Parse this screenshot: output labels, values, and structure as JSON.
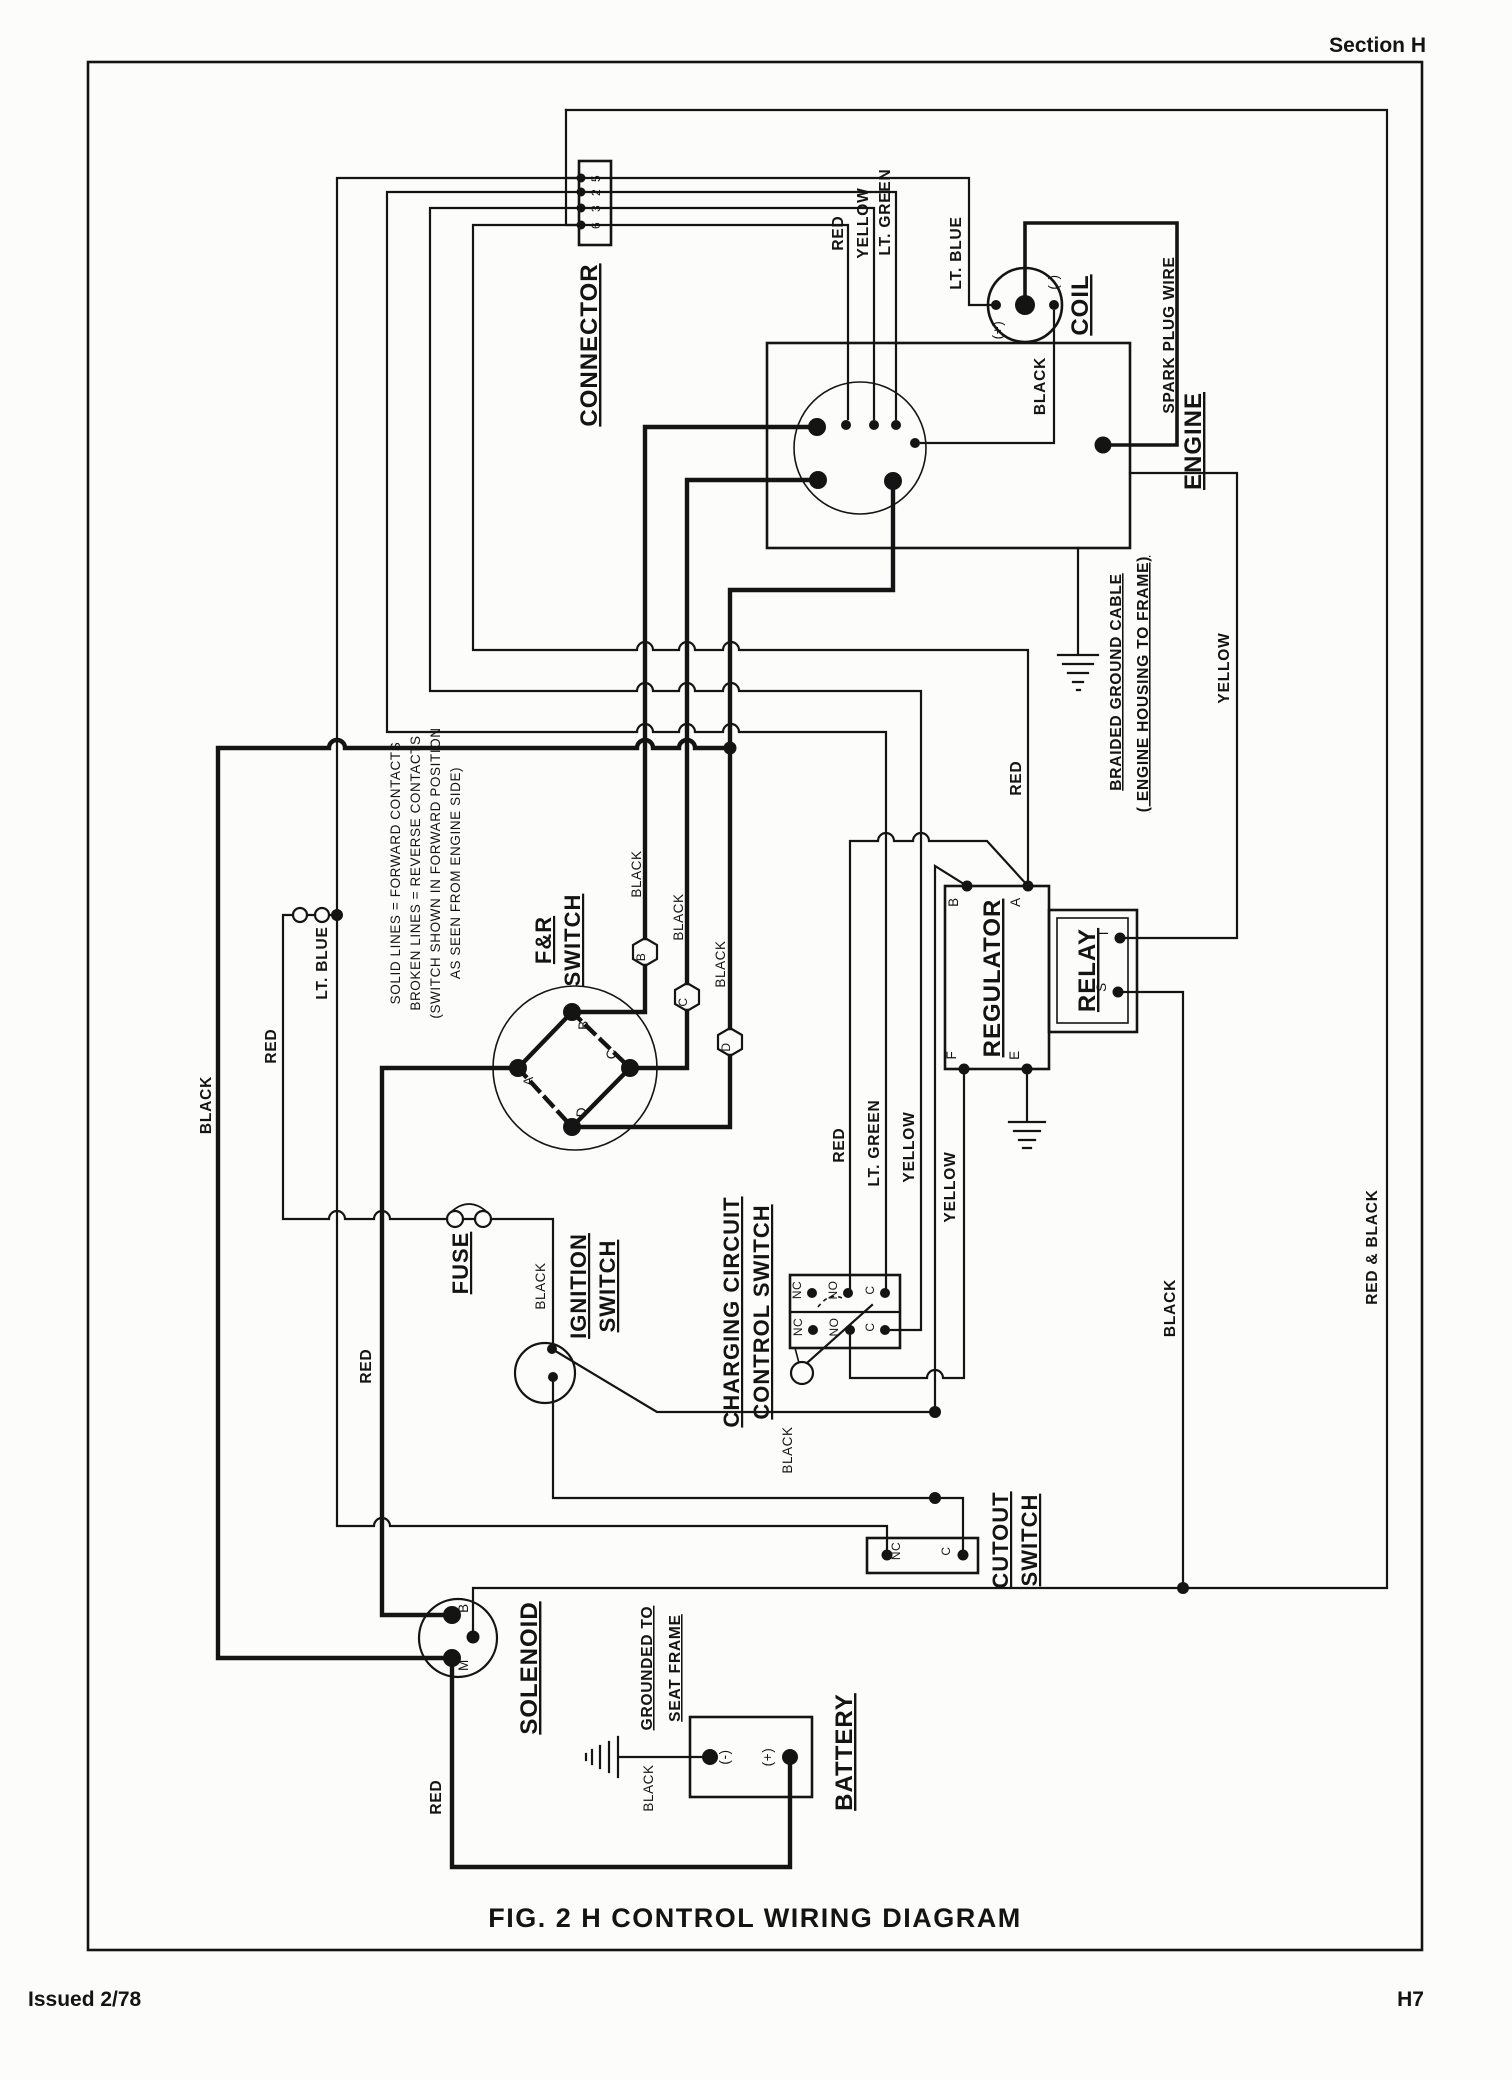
{
  "page": {
    "section_header": "Section H",
    "title": "FIG. 2 H    CONTROL WIRING DIAGRAM",
    "issued": "Issued 2/78",
    "page_no": "H7"
  },
  "labels": {
    "connector": "CONNECTOR",
    "pin5": "5",
    "pin2": "2",
    "pin3": "3",
    "pin6": "6",
    "red_conn": "RED",
    "yellow_conn": "YELLOW",
    "ltgreen_conn": "LT. GREEN",
    "ltblue_conn": "LT. BLUE",
    "coil": "COIL",
    "coil_pos": "(+)",
    "coil_neg": "(-)",
    "black_coil": "BLACK",
    "spark": "SPARK  PLUG  WIRE",
    "engine": "ENGINE",
    "braided1": "BRAIDED  GROUND  CABLE",
    "braided2": "( ENGINE  HOUSING  TO  FRAME)",
    "yellow_right": "YELLOW",
    "note1": "SOLID LINES = FORWARD CONTACTS",
    "note2": "BROKEN LINES = REVERSE CONTACTS",
    "note3": "(SWITCH SHOWN IN FORWARD POSITION",
    "note4": "AS SEEN FROM ENGINE SIDE)",
    "fr1": "F&R",
    "fr2": "SWITCH",
    "frA": "A",
    "frB": "B",
    "frC": "C",
    "frD": "D",
    "hexB": "B",
    "hexC": "C",
    "hexD": "D",
    "black_hexB": "BLACK",
    "black_hexC": "BLACK",
    "black_hexD": "BLACK",
    "ltblue_left": "LT. BLUE",
    "red_left": "RED",
    "black_left": "BLACK",
    "red_awire": "RED",
    "fuse": "FUSE",
    "black_fuse": "BLACK",
    "ignition1": "IGNITION",
    "ignition2": "SWITCH",
    "charging1": "CHARGING CIRCUIT",
    "charging2": "CONTROL SWITCH",
    "cc_nc1": "NC",
    "cc_no1": "NO",
    "cc_c1": "C",
    "cc_nc2": "NC",
    "cc_no2": "NO",
    "cc_c2": "C",
    "regulator": "REGULATOR",
    "regB": "B",
    "regA": "A",
    "regF": "F",
    "regE": "E",
    "relay": "RELAY",
    "relayI": "I",
    "relayS": "S",
    "red_mid": "RED",
    "red_drop": "RED",
    "ltgreen_drop": "LT. GREEN",
    "yellow_drop": "YELLOW",
    "yellow_f": "YELLOW",
    "black_s": "BLACK",
    "redblack": "RED  &  BLACK",
    "cutout1": "CUTOUT",
    "cutout2": "SWITCH",
    "cut_nc": "NC",
    "cut_c": "C",
    "solenoid": "SOLENOID",
    "solB": "B",
    "solM": "M",
    "seat1": "GROUNDED  TO",
    "seat2": "SEAT  FRAME",
    "battery": "BATTERY",
    "bat_neg": "(-)",
    "bat_pos": "(+)",
    "black_bat": "BLACK",
    "red_bat": "RED"
  }
}
